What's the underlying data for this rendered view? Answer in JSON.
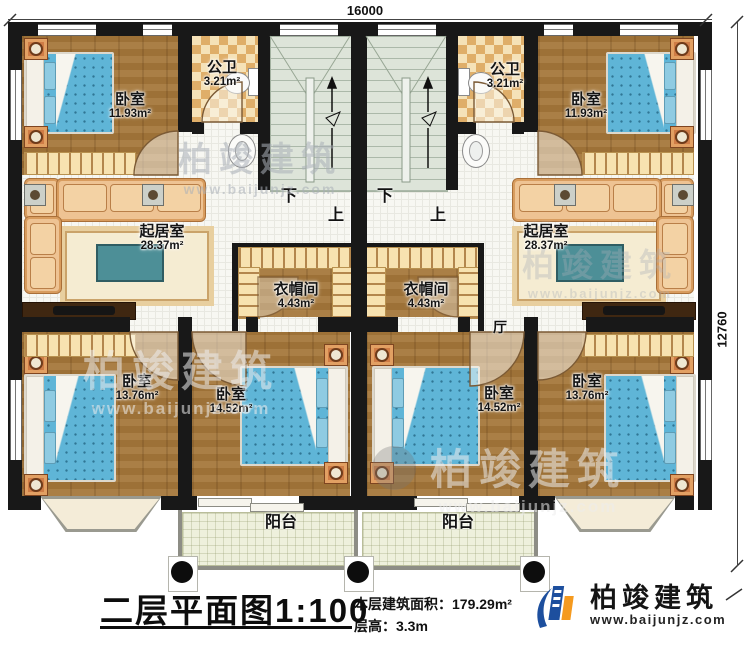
{
  "dimensions": {
    "top": "16000",
    "right": "12760"
  },
  "rooms": {
    "bedroom_tl": {
      "label": "卧室",
      "area": "11.93m²"
    },
    "bedroom_tr": {
      "label": "卧室",
      "area": "11.93m²"
    },
    "bath_l": {
      "label": "公卫",
      "area": "3.21m²"
    },
    "bath_r": {
      "label": "公卫",
      "area": "3.21m²"
    },
    "living_l": {
      "label": "起居室",
      "area": "28.37m²"
    },
    "living_r": {
      "label": "起居室",
      "area": "28.37m²"
    },
    "cloak_l": {
      "label": "衣帽间",
      "area": "4.43m²"
    },
    "cloak_r": {
      "label": "衣帽间",
      "area": "4.43m²"
    },
    "bedroom_bl": {
      "label": "卧室",
      "area": "13.76m²"
    },
    "bedroom_bml": {
      "label": "卧室",
      "area": "14.52m²"
    },
    "bedroom_bmr": {
      "label": "卧室",
      "area": "14.52m²"
    },
    "bedroom_br": {
      "label": "卧室",
      "area": "13.76m²"
    },
    "balcony_l": {
      "label": "阳台"
    },
    "balcony_r": {
      "label": "阳台"
    },
    "hall": {
      "label": "厅"
    }
  },
  "stairs": {
    "down": "下",
    "up": "上"
  },
  "titleblock": {
    "title": "二层平面图",
    "scale": "1:100",
    "area_label": "本层建筑面积：",
    "area_value": "179.29m²",
    "floor_height_label": "层高：",
    "floor_height_value": "3.3m"
  },
  "logo": {
    "name": "柏竣建筑",
    "url": "www.baijunjz.com"
  },
  "watermark": {
    "text": "柏竣建筑",
    "url": "www.baijunjz.com"
  },
  "colors": {
    "wall": "#181818",
    "wood_floor": "#a5773a",
    "tile_floor": "#f6f6f1",
    "bath_checker_light": "#f5e2b8",
    "bath_checker_dark": "#dfae69",
    "stair": "#dde4d9",
    "bed": "#5fb5d7",
    "sofa": "#eec393",
    "balcony": "#eef0dc",
    "logo_blue": "#1d4f9e",
    "logo_orange": "#f59a1f"
  }
}
